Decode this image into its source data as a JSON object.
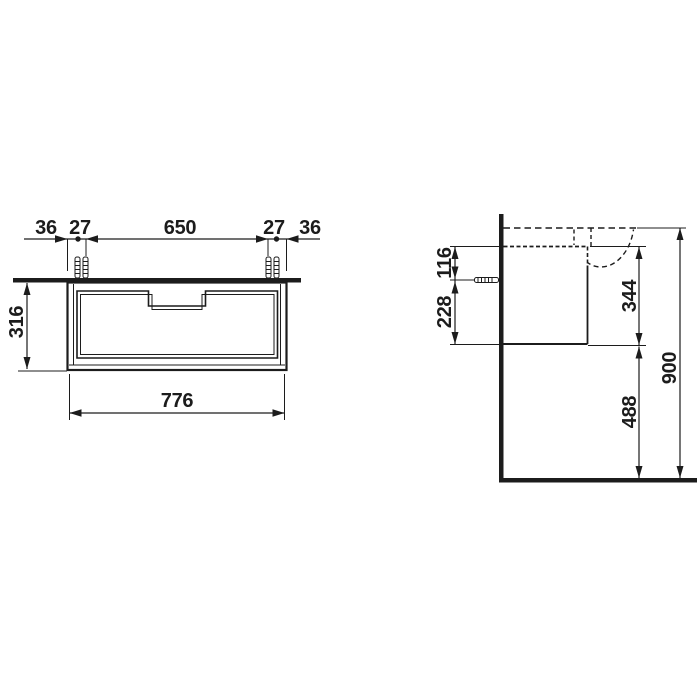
{
  "drawing": {
    "type": "technical-dimension-drawing",
    "views": [
      "front",
      "side"
    ],
    "colors": {
      "line": "#1c1c1c",
      "background": "#ffffff"
    }
  },
  "front": {
    "offset_left": "36",
    "plug_gap_left": "27",
    "span_center": "650",
    "plug_gap_right": "27",
    "offset_right": "36",
    "height": "316",
    "width": "776"
  },
  "side": {
    "screw_from_top": "116",
    "screw_from_bottom": "228",
    "body_height": "344",
    "floor_clearance": "488",
    "overall_height": "900"
  }
}
